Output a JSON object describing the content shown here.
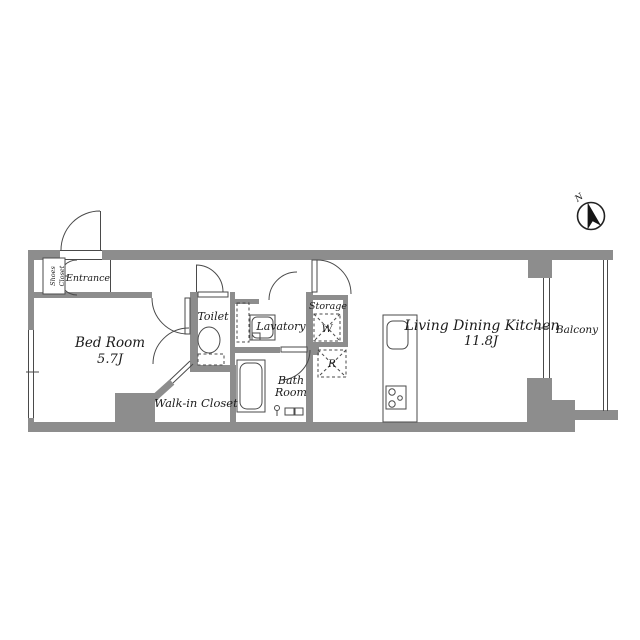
{
  "plan": {
    "bed_room": {
      "line1": "Bed Room",
      "line2": "5.7J"
    },
    "ldk": {
      "line1": "Living Dining Kitchen",
      "line2": "11.8J"
    },
    "toilet": "Toilet",
    "lavatory": "Lavatory",
    "storage": "Storage",
    "bath_room": {
      "line1": "Bath",
      "line2": "Room"
    },
    "walk_in_closet": "Walk-in Closet",
    "balcony": "Balcony",
    "entrance": "Entrance",
    "shoes_closet": {
      "line1": "Shoes",
      "line2": "Closet"
    },
    "washer_symbol": "W",
    "refrigerator_symbol": "R"
  },
  "compass": {
    "north": "N"
  },
  "colors": {
    "wall": "#8d8d8d",
    "line": "#4a4a4a",
    "text": "#1b1b1b"
  }
}
